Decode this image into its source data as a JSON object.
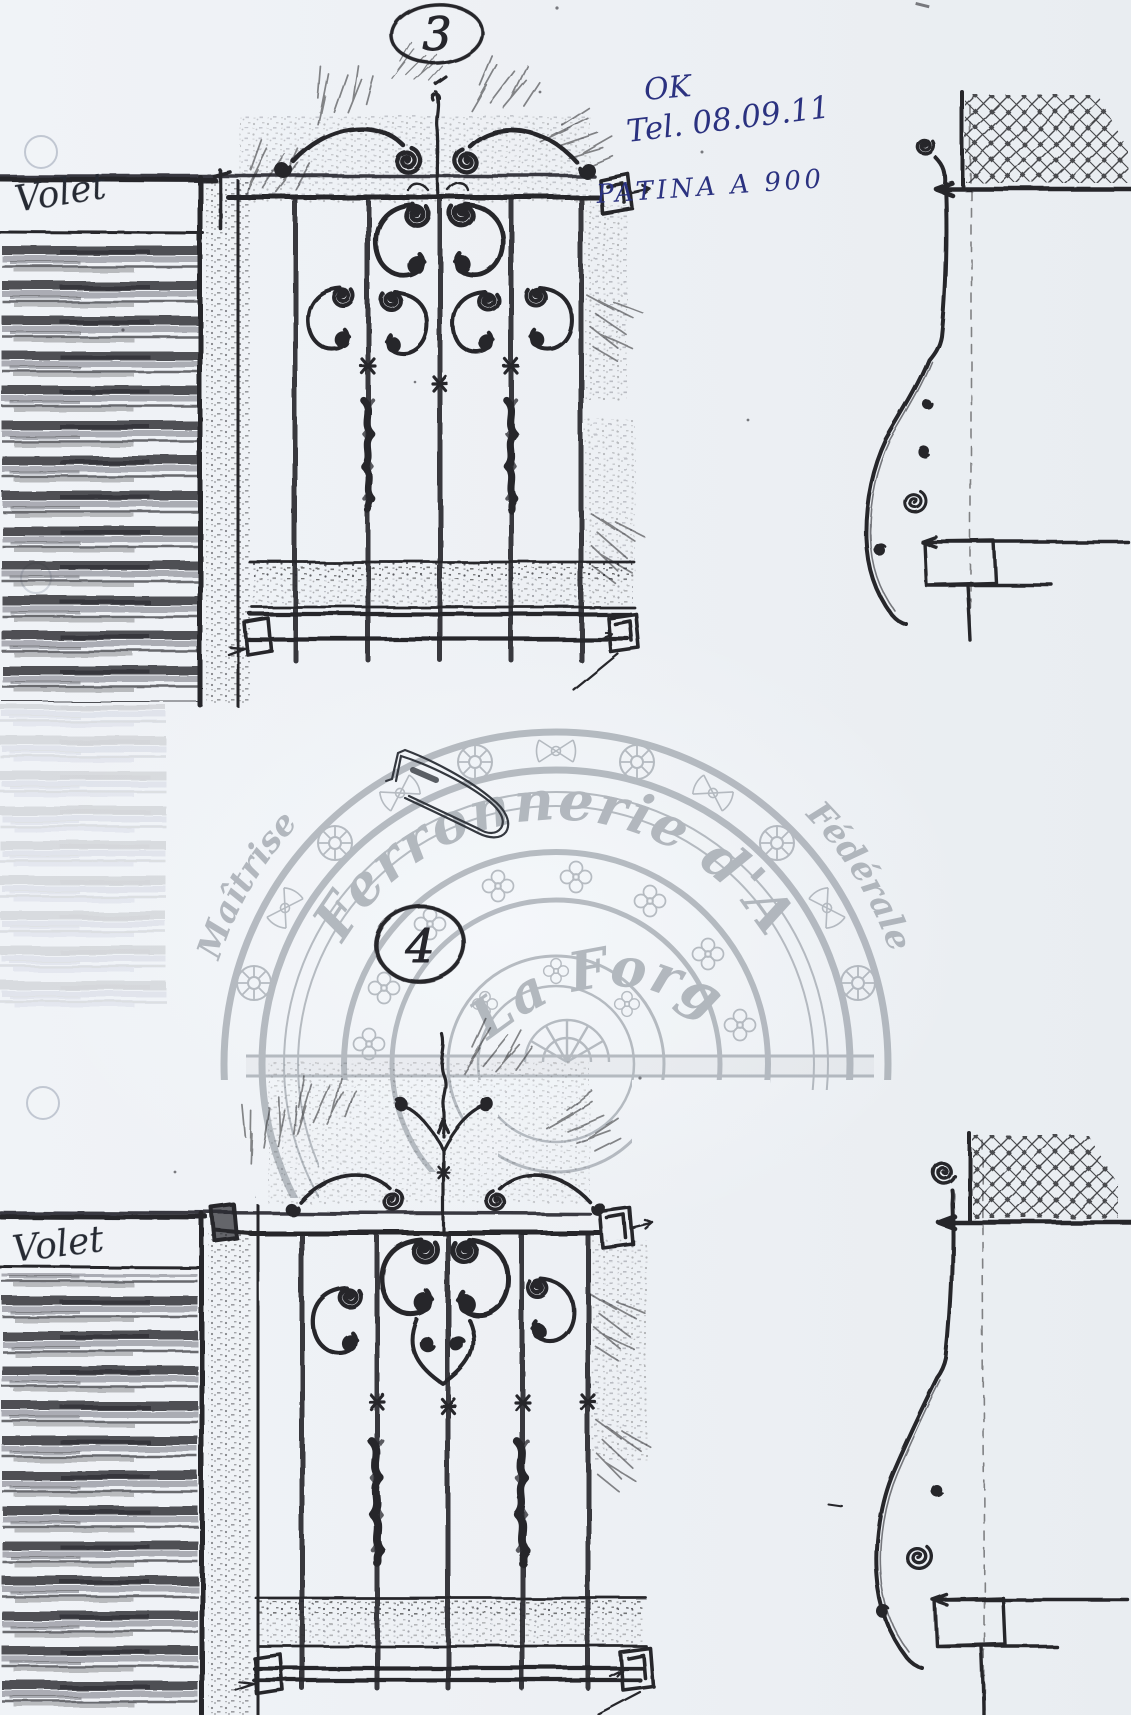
{
  "designs": {
    "top_number": "3",
    "bottom_number": "4"
  },
  "annotations": {
    "approval": "OK",
    "date_note": "Tel. 08.09.11",
    "patina_note": "PATINA A 900"
  },
  "shutters": {
    "top_label": "Volet",
    "bottom_label": "Volet"
  },
  "watermark": {
    "arc_left": "Maîtrise",
    "arc_right": "Fédérale",
    "title": "Ferronnerie d'Art",
    "subtitle": "La Forge"
  },
  "colors": {
    "paper": "#edf0f4",
    "pencil": "#26262c",
    "ink_blue": "#2b3280",
    "ink_dark": "#262a33",
    "watermark_gray": "#848b94"
  }
}
